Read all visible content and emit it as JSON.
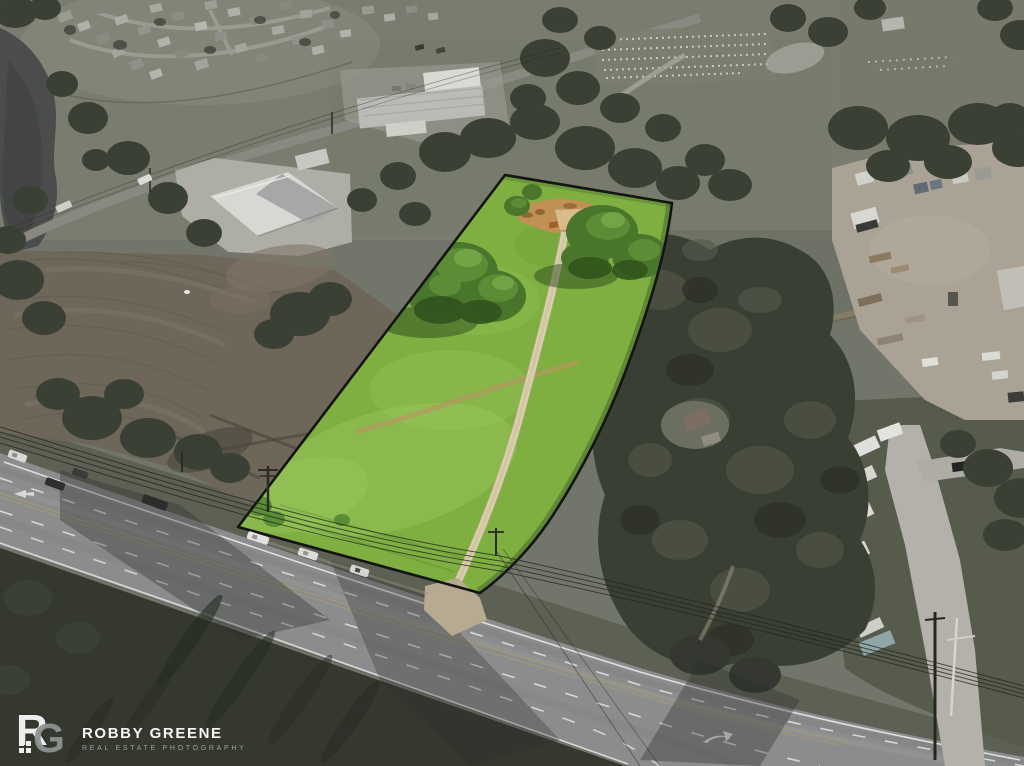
{
  "meta": {
    "asset_type": "aerial drone photograph",
    "subject": "vacant land real-estate listing with color-highlighted lot boundary",
    "canvas": {
      "width": 1024,
      "height": 766
    }
  },
  "watermark": {
    "logo_r": "R",
    "logo_g": "G",
    "name": "ROBBY GREENE",
    "tagline": "REAL ESTATE PHOTOGRAPHY",
    "name_color": "#f7f7f5",
    "tagline_color": "#9aa0a0"
  },
  "scene": {
    "highlighted_parcel": {
      "description": "long narrow lot rendered in saturated green against desaturated surroundings, black boundary line",
      "fill": "#7fae41",
      "outline": "#141414",
      "features": [
        "gravel driveway up the center",
        "dirt clearing at rear of lot",
        "two large tree clusters",
        "diagonal dirt track",
        "driveway apron onto highway"
      ]
    },
    "surroundings": [
      "multi-lane highway running diagonally across bottom with dashed lane lines, double center line and turn arrow",
      "cars on highway",
      "residential subdivision top-left",
      "pond with tree-lined bank top-left",
      "plowed field with contour rows on left",
      "commercial building with gray gable roof and concrete apron",
      "white warehouse buildings top-center",
      "cemetery with rows of headstones top-right",
      "contractor dirt yard with trailers and lumber on right",
      "rv storage rows along concrete drive lower-right",
      "teal shipping container lower-right",
      "large dark oak canopy with house right of parcel",
      "power lines and utility poles along highway"
    ],
    "palette": {
      "highlight_green": "#7fae41",
      "parcel_outline": "#141414",
      "driveway_gravel": "#ddd3b4",
      "clearing_dirt": "#c09154",
      "asphalt": "#8b8c8d",
      "lane_marking": "#eceeea",
      "center_line": "#a89a6f",
      "desaturated_field": "#72766a",
      "plowed_field": "#6e6759",
      "dark_trees": "#3b4035",
      "water": "#4a4d4b",
      "concrete": "#b3b1a9",
      "yard_dirt": "#aaa294"
    }
  }
}
